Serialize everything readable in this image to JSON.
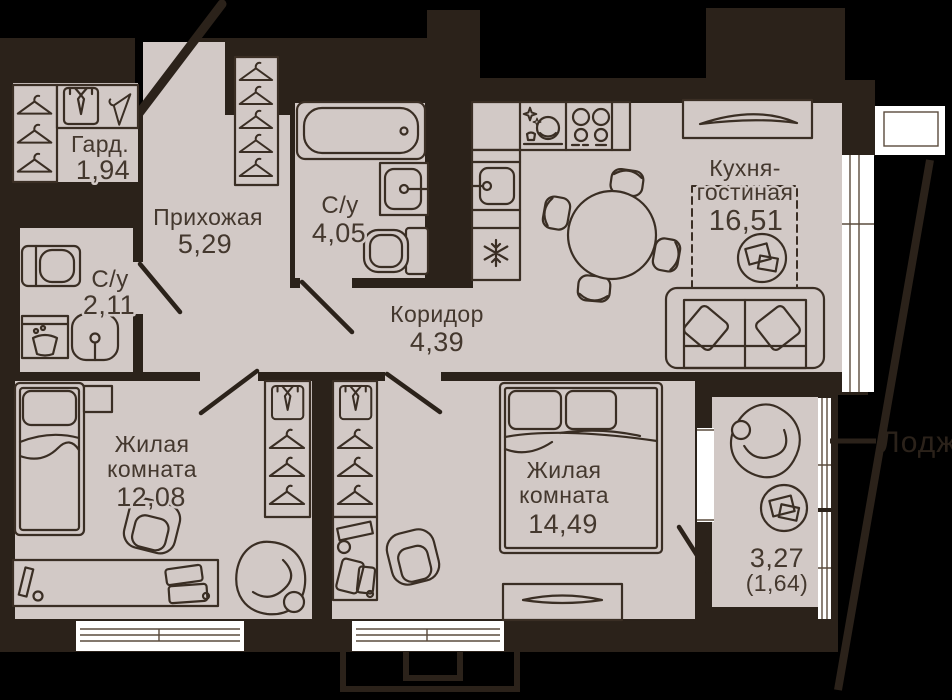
{
  "plan_type": "apartment-floor-plan",
  "colors": {
    "background": "#000000",
    "walls": "#2b221a",
    "floor": "#d2c9c6",
    "furniture_outline": "#3a2e24",
    "label_text": "#44382e",
    "window": "#ffffff"
  },
  "rooms": [
    {
      "id": "wardrobe",
      "name": "Гард.",
      "area": "1,94"
    },
    {
      "id": "hallway",
      "name": "Прихожая",
      "area": "5,29"
    },
    {
      "id": "bathroom-large",
      "name": "С/у",
      "area": "4,05"
    },
    {
      "id": "bathroom-small",
      "name": "С/у",
      "area": "2,11"
    },
    {
      "id": "corridor",
      "name": "Коридор",
      "area": "4,39"
    },
    {
      "id": "kitchen-living",
      "name_line1": "Кухня-",
      "name_line2": "гостиная",
      "area": "16,51"
    },
    {
      "id": "bedroom-1",
      "name_line1": "Жилая",
      "name_line2": "комната",
      "area": "12,08"
    },
    {
      "id": "bedroom-2",
      "name_line1": "Жилая",
      "name_line2": "комната",
      "area": "14,49"
    },
    {
      "id": "loggia",
      "area": "3,27",
      "area_reduced": "(1,64)"
    }
  ],
  "context": {
    "adjacent_area_label": "Лоджия"
  },
  "icons": [
    "hanger-icon",
    "shirt-icon",
    "bathtub-icon",
    "sink-icon",
    "toilet-icon",
    "washing-machine-icon",
    "stove-icon",
    "dishwasher-icon",
    "fridge-snowflake-icon",
    "dining-table-icon",
    "dining-chair-icon",
    "sofa-icon",
    "pillow-icon",
    "tv-console-icon",
    "single-bed-icon",
    "double-bed-icon",
    "desk-icon",
    "armchair-icon",
    "office-chair-icon",
    "bean-bag-icon",
    "dresser-icon",
    "side-table-icon",
    "rug-icon",
    "window-icon",
    "door-swing-icon"
  ]
}
